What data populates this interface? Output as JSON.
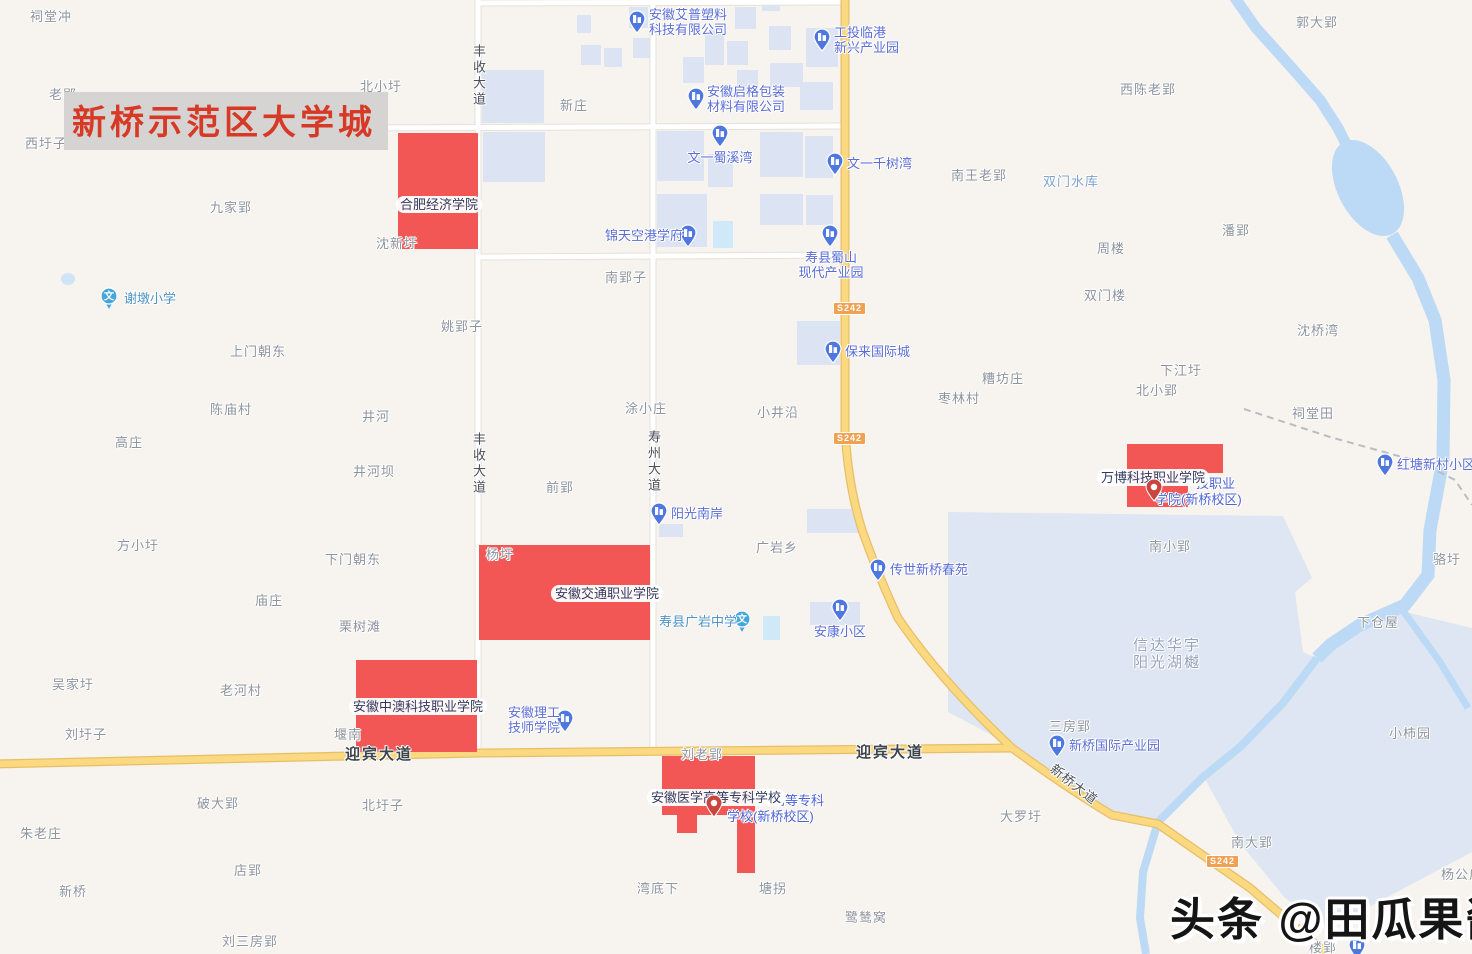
{
  "map": {
    "title": "新桥示范区大学城",
    "watermark": "头条 @田瓜果酱",
    "colors": {
      "land": "#F7F3EE",
      "building": "#DCE4F3",
      "pond": "#CFE9F8",
      "water": "#BCD9F5",
      "aoi_area": "#DDE6F2",
      "road_white": "#FFFFFF",
      "road_white_edge": "#E5E1DA",
      "road_yellow": "#FAD980",
      "road_yellow_edge": "#E9BE69",
      "red_area": "#F25755",
      "poi_pin": "#4E77E0",
      "school_pin": "#45A6DC",
      "red_pin": "#C9463E",
      "badge": "#F0A152",
      "title_red": "#D63A26"
    },
    "icons": {
      "building_pin": "building-pin-icon",
      "school_pin": "school-pin-icon",
      "red_pin": "place-pin-icon",
      "school_glyph": "文"
    },
    "route_badges": [
      {
        "text": "S242",
        "x": 833,
        "y": 302
      },
      {
        "text": "S242",
        "x": 833,
        "y": 432
      },
      {
        "text": "S242",
        "x": 1206,
        "y": 855
      }
    ],
    "road_labels": [
      {
        "text": "丰收大道",
        "x": 470,
        "y": 44,
        "kind": "v"
      },
      {
        "text": "丰收大道",
        "x": 470,
        "y": 432,
        "kind": "v"
      },
      {
        "text": "寿州大道",
        "x": 645,
        "y": 430,
        "kind": "v"
      },
      {
        "text": "迎宾大道",
        "x": 345,
        "y": 746,
        "kind": "big"
      },
      {
        "text": "迎宾大道",
        "x": 856,
        "y": 744,
        "kind": "big"
      },
      {
        "text": "新桥大道",
        "x": 1056,
        "y": 762,
        "kind": "rot",
        "angle": 38
      }
    ],
    "campuses": [
      {
        "label": "合肥经济学院",
        "x": 396,
        "y": 196
      },
      {
        "label": "安徽交通职业学院",
        "x": 551,
        "y": 585
      },
      {
        "label": "安徽中澳科技职业学院",
        "x": 349,
        "y": 698
      },
      {
        "label": "安徽医学高等专科学校",
        "x": 647,
        "y": 789
      },
      {
        "label": "万博科技职业学院",
        "x": 1097,
        "y": 469
      }
    ],
    "campus_fragments": [
      {
        "text": "技职业",
        "x": 1196,
        "y": 477
      },
      {
        "text": "学院(新桥校区)",
        "x": 1155,
        "y": 493
      },
      {
        "text": "高等专科",
        "x": 772,
        "y": 794
      },
      {
        "text": "学校(新桥校区)",
        "x": 727,
        "y": 810
      }
    ],
    "pois": [
      {
        "name": "安徽艾普塑料科技有限公司",
        "lines": [
          "安徽艾普塑料",
          "科技有限公司"
        ],
        "pin": "building",
        "px": 637,
        "py": 20,
        "tx": 649,
        "ty": 7,
        "align": "left"
      },
      {
        "name": "工投临港新兴产业园",
        "lines": [
          "工投临港",
          "新兴产业园"
        ],
        "pin": "building",
        "px": 822,
        "py": 38,
        "tx": 834,
        "ty": 25,
        "align": "left"
      },
      {
        "name": "安徽启格包装材料有限公司",
        "lines": [
          "安徽启格包装",
          "材料有限公司"
        ],
        "pin": "building",
        "px": 696,
        "py": 97,
        "tx": 707,
        "ty": 84,
        "align": "left"
      },
      {
        "name": "文一蜀溪湾",
        "lines": [
          "文一蜀溪湾"
        ],
        "pin": "building",
        "px": 720,
        "py": 134,
        "tx": 720,
        "ty": 150,
        "align": "center"
      },
      {
        "name": "文一千树湾",
        "lines": [
          "文一千树湾"
        ],
        "pin": "building",
        "px": 835,
        "py": 162,
        "tx": 847,
        "ty": 156,
        "align": "left"
      },
      {
        "name": "锦天空港学府",
        "lines": [
          "锦天空港学府"
        ],
        "pin": "building",
        "px": 688,
        "py": 234,
        "tx": 683,
        "ty": 228,
        "align": "right"
      },
      {
        "name": "寿县蜀山现代产业园",
        "lines": [
          "寿县蜀山",
          "现代产业园"
        ],
        "pin": "building",
        "px": 830,
        "py": 234,
        "tx": 831,
        "ty": 250,
        "align": "center"
      },
      {
        "name": "谢墩小学",
        "lines": [
          "谢墩小学"
        ],
        "pin": "school",
        "px": 109,
        "py": 297,
        "tx": 124,
        "ty": 291,
        "align": "left"
      },
      {
        "name": "保来国际城",
        "lines": [
          "保来国际城"
        ],
        "pin": "building",
        "px": 833,
        "py": 350,
        "tx": 845,
        "ty": 344,
        "align": "left"
      },
      {
        "name": "阳光南岸",
        "lines": [
          "阳光南岸"
        ],
        "pin": "building",
        "px": 659,
        "py": 512,
        "tx": 671,
        "ty": 506,
        "align": "left"
      },
      {
        "name": "传世新桥春苑",
        "lines": [
          "传世新桥春苑"
        ],
        "pin": "building",
        "px": 878,
        "py": 568,
        "tx": 890,
        "ty": 562,
        "align": "left"
      },
      {
        "name": "安康小区",
        "lines": [
          "安康小区"
        ],
        "pin": "building",
        "px": 840,
        "py": 608,
        "tx": 840,
        "ty": 624,
        "align": "center"
      },
      {
        "name": "寿县广岩中学",
        "lines": [
          "寿县广岩中学"
        ],
        "pin": "school",
        "px": 742,
        "py": 620,
        "tx": 737,
        "ty": 614,
        "align": "right",
        "school": true
      },
      {
        "name": "安徽理工技师学院",
        "lines": [
          "安徽理工",
          "技师学院"
        ],
        "pin": "building",
        "px": 565,
        "py": 719,
        "tx": 560,
        "ty": 705,
        "align": "right"
      },
      {
        "name": "新桥国际产业园",
        "lines": [
          "新桥国际产业园"
        ],
        "pin": "building",
        "px": 1057,
        "py": 744,
        "tx": 1069,
        "ty": 738,
        "align": "left"
      },
      {
        "name": "红塘新村小区",
        "lines": [
          "红塘新村小区"
        ],
        "pin": "building",
        "px": 1385,
        "py": 463,
        "tx": 1397,
        "ty": 457,
        "align": "left"
      },
      {
        "name": "楼郢旁小区",
        "lines": [],
        "pin": "building",
        "px": 1357,
        "py": 946,
        "tx": 1357,
        "ty": 960,
        "align": "left"
      }
    ],
    "red_pins": [
      {
        "x": 714,
        "y": 804
      },
      {
        "x": 1154,
        "y": 488
      }
    ],
    "villages": [
      {
        "text": "祠堂冲",
        "x": 30,
        "y": 10
      },
      {
        "text": "郭大郢",
        "x": 1296,
        "y": 16
      },
      {
        "text": "老郢",
        "x": 49,
        "y": 88
      },
      {
        "text": "北小圩",
        "x": 360,
        "y": 80
      },
      {
        "text": "西陈老郢",
        "x": 1120,
        "y": 83
      },
      {
        "text": "新庄",
        "x": 560,
        "y": 99
      },
      {
        "text": "南郢",
        "x": 345,
        "y": 134
      },
      {
        "text": "西圩子",
        "x": 25,
        "y": 137
      },
      {
        "text": "南王老郢",
        "x": 951,
        "y": 169
      },
      {
        "text": "九家郢",
        "x": 210,
        "y": 201
      },
      {
        "text": "潘郢",
        "x": 1222,
        "y": 224
      },
      {
        "text": "周楼",
        "x": 1097,
        "y": 242
      },
      {
        "text": "沈新圩",
        "x": 376,
        "y": 237
      },
      {
        "text": "南郢子",
        "x": 605,
        "y": 271
      },
      {
        "text": "双门楼",
        "x": 1084,
        "y": 289
      },
      {
        "text": "姚郢子",
        "x": 441,
        "y": 320
      },
      {
        "text": "沈桥湾",
        "x": 1297,
        "y": 324
      },
      {
        "text": "上门朝东",
        "x": 230,
        "y": 345
      },
      {
        "text": "下江圩",
        "x": 1160,
        "y": 364
      },
      {
        "text": "糟坊庄",
        "x": 982,
        "y": 372
      },
      {
        "text": "北小郢",
        "x": 1136,
        "y": 384
      },
      {
        "text": "陈庙村",
        "x": 210,
        "y": 403
      },
      {
        "text": "枣林村",
        "x": 938,
        "y": 392
      },
      {
        "text": "井河",
        "x": 362,
        "y": 410
      },
      {
        "text": "涂小庄",
        "x": 625,
        "y": 402
      },
      {
        "text": "小井沿",
        "x": 757,
        "y": 406
      },
      {
        "text": "祠堂田",
        "x": 1292,
        "y": 407
      },
      {
        "text": "高庄",
        "x": 115,
        "y": 436
      },
      {
        "text": "井河坝",
        "x": 353,
        "y": 465
      },
      {
        "text": "前郢",
        "x": 546,
        "y": 481
      },
      {
        "text": "方小圩",
        "x": 117,
        "y": 539
      },
      {
        "text": "广岩乡",
        "x": 756,
        "y": 541
      },
      {
        "text": "南小郢",
        "x": 1149,
        "y": 540
      },
      {
        "text": "下门朝东",
        "x": 325,
        "y": 553
      },
      {
        "text": "骆圩",
        "x": 1433,
        "y": 553
      },
      {
        "text": "庙庄",
        "x": 255,
        "y": 594
      },
      {
        "text": "杨圩",
        "x": 486,
        "y": 548
      },
      {
        "text": "栗树滩",
        "x": 339,
        "y": 620
      },
      {
        "text": "下仓屋",
        "x": 1357,
        "y": 616
      },
      {
        "text": "吴家圩",
        "x": 52,
        "y": 678
      },
      {
        "text": "老河村",
        "x": 220,
        "y": 684
      },
      {
        "text": "小柿园",
        "x": 1389,
        "y": 727
      },
      {
        "text": "三房郢",
        "x": 1049,
        "y": 720
      },
      {
        "text": "刘圩子",
        "x": 65,
        "y": 728
      },
      {
        "text": "堰南",
        "x": 334,
        "y": 728
      },
      {
        "text": "刘老郢",
        "x": 681,
        "y": 748
      },
      {
        "text": "大罗圩",
        "x": 1000,
        "y": 810
      },
      {
        "text": "破大郢",
        "x": 197,
        "y": 797
      },
      {
        "text": "北圩子",
        "x": 362,
        "y": 799
      },
      {
        "text": "朱老庄",
        "x": 20,
        "y": 827
      },
      {
        "text": "南大郢",
        "x": 1231,
        "y": 836
      },
      {
        "text": "店郢",
        "x": 234,
        "y": 864
      },
      {
        "text": "新桥",
        "x": 59,
        "y": 885
      },
      {
        "text": "湾底下",
        "x": 637,
        "y": 882
      },
      {
        "text": "塘拐",
        "x": 759,
        "y": 882
      },
      {
        "text": "鹭鸶窝",
        "x": 845,
        "y": 911
      },
      {
        "text": "刘三房郢",
        "x": 222,
        "y": 935
      },
      {
        "text": "楼郢",
        "x": 1309,
        "y": 941
      },
      {
        "text": "杨公庙",
        "x": 1441,
        "y": 868
      }
    ],
    "water_labels": [
      {
        "text": "双门水库",
        "x": 1043,
        "y": 175
      }
    ],
    "area_labels": [
      {
        "lines": [
          "信达华宇",
          "阳光湖樾"
        ],
        "x": 1167,
        "y": 637
      }
    ]
  }
}
